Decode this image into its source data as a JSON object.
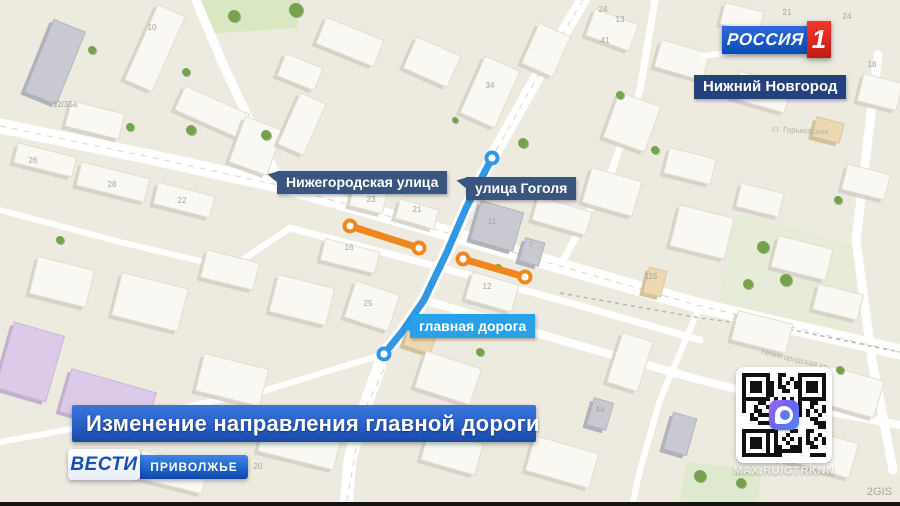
{
  "branding": {
    "channel": "РОССИЯ",
    "channel_number": "1",
    "region_label": "Нижний Новгород",
    "vesti": "ВЕСТИ",
    "vesti_region": "ПРИВОЛЖЬЕ"
  },
  "headline": "Изменение направления главной дороги",
  "map_labels": {
    "street1": "Нижегородская улица",
    "street2": "улица Гоголя",
    "main_road": "главная дорога"
  },
  "qr": {
    "caption": "MAX.RU/GTRKNN",
    "icon": "max-messenger-icon"
  },
  "watermark": "2GIS",
  "colors": {
    "map_bg": "#edeae0",
    "road": "#ffffff",
    "street_tag": "#3a557e",
    "city_tag": "#24417c",
    "mainroad_tag": "#2aa0e8",
    "route_blue": "#2f97e3",
    "route_orange": "#f0861e",
    "banner_top": "#3a77dd",
    "banner_bottom": "#1b4aa8",
    "rossiya_blue": "#0c4ab8",
    "rossiya_red": "#d8231a"
  },
  "map": {
    "park": [
      {
        "pts": [
          [
            200,
            0
          ],
          [
            300,
            0
          ],
          [
            297,
            28
          ],
          [
            204,
            34
          ]
        ],
        "c": "#d9e8c2"
      },
      {
        "pts": [
          [
            735,
            213
          ],
          [
            862,
            248
          ],
          [
            846,
            342
          ],
          [
            718,
            302
          ]
        ],
        "c": "#e7ecd9"
      },
      {
        "pts": [
          [
            686,
            462
          ],
          [
            762,
            470
          ],
          [
            758,
            506
          ],
          [
            680,
            506
          ]
        ],
        "c": "#dfe9cd"
      }
    ],
    "roads": [
      {
        "pts": [
          [
            0,
            210
          ],
          [
            120,
            242
          ],
          [
            230,
            268
          ],
          [
            290,
            228
          ]
        ],
        "w": 6
      },
      {
        "pts": [
          [
            384,
            354
          ],
          [
            260,
            392
          ],
          [
            120,
            420
          ],
          [
            0,
            442
          ]
        ],
        "w": 6
      },
      {
        "pts": [
          [
            560,
            266
          ],
          [
            612,
            170
          ],
          [
            640,
            90
          ],
          [
            655,
            0
          ]
        ],
        "w": 7
      },
      {
        "pts": [
          [
            290,
            228
          ],
          [
            420,
            262
          ],
          [
            560,
            300
          ],
          [
            700,
            340
          ]
        ],
        "w": 7
      },
      {
        "pts": [
          [
            424,
            300
          ],
          [
            560,
            340
          ],
          [
            700,
            380
          ],
          [
            830,
            412
          ],
          [
            900,
            425
          ]
        ],
        "w": 8
      },
      {
        "pts": [
          [
            700,
            306
          ],
          [
            660,
            400
          ],
          [
            640,
            470
          ],
          [
            632,
            506
          ]
        ],
        "w": 6
      },
      {
        "pts": [
          [
            878,
            55
          ],
          [
            856,
            240
          ],
          [
            872,
            360
          ],
          [
            893,
            470
          ]
        ],
        "w": 9
      },
      {
        "pts": [
          [
            196,
            0
          ],
          [
            222,
            62
          ],
          [
            250,
            122
          ],
          [
            282,
            186
          ]
        ],
        "w": 9
      },
      {
        "pts": [
          [
            583,
            0
          ],
          [
            540,
            72
          ],
          [
            492,
            158
          ],
          [
            466,
            208
          ],
          [
            447,
            252
          ],
          [
            424,
            300
          ],
          [
            402,
            332
          ],
          [
            384,
            354
          ],
          [
            362,
            415
          ],
          [
            350,
            460
          ],
          [
            346,
            506
          ]
        ],
        "w": 13
      },
      {
        "pts": [
          [
            0,
            126
          ],
          [
            150,
            157
          ],
          [
            282,
            186
          ],
          [
            430,
            228
          ],
          [
            560,
            266
          ],
          [
            700,
            306
          ],
          [
            900,
            352
          ]
        ],
        "w": 15
      }
    ],
    "centerlines": [
      {
        "pts": [
          [
            0,
            126
          ],
          [
            150,
            157
          ],
          [
            282,
            186
          ],
          [
            430,
            228
          ],
          [
            560,
            266
          ],
          [
            700,
            306
          ],
          [
            900,
            352
          ]
        ]
      },
      {
        "pts": [
          [
            583,
            0
          ],
          [
            540,
            72
          ],
          [
            492,
            158
          ],
          [
            447,
            252
          ],
          [
            402,
            332
          ],
          [
            362,
            415
          ],
          [
            346,
            506
          ]
        ]
      }
    ],
    "boundary": {
      "pts": [
        [
          560,
          293
        ],
        [
          700,
          318
        ],
        [
          793,
          330
        ],
        [
          900,
          352
        ]
      ]
    },
    "buildings": [
      {
        "x": 55,
        "y": 62,
        "w": 34,
        "h": 78,
        "r": 22,
        "c": "g"
      },
      {
        "x": 155,
        "y": 48,
        "w": 30,
        "h": 82,
        "r": 24,
        "c": "w"
      },
      {
        "x": 95,
        "y": 120,
        "w": 55,
        "h": 26,
        "r": 14,
        "c": "w"
      },
      {
        "x": 212,
        "y": 112,
        "w": 70,
        "h": 26,
        "r": 24,
        "c": "w"
      },
      {
        "x": 45,
        "y": 160,
        "w": 60,
        "h": 20,
        "r": 14,
        "c": "w"
      },
      {
        "x": 113,
        "y": 182,
        "w": 70,
        "h": 24,
        "r": 14,
        "c": "w"
      },
      {
        "x": 184,
        "y": 200,
        "w": 58,
        "h": 22,
        "r": 14,
        "c": "w"
      },
      {
        "x": 256,
        "y": 146,
        "w": 40,
        "h": 48,
        "r": 20,
        "c": "w"
      },
      {
        "x": 302,
        "y": 124,
        "w": 28,
        "h": 56,
        "r": 24,
        "c": "w"
      },
      {
        "x": 350,
        "y": 42,
        "w": 62,
        "h": 28,
        "r": 22,
        "c": "w"
      },
      {
        "x": 300,
        "y": 72,
        "w": 40,
        "h": 24,
        "r": 22,
        "c": "w"
      },
      {
        "x": 432,
        "y": 62,
        "w": 48,
        "h": 34,
        "r": 24,
        "c": "w"
      },
      {
        "x": 490,
        "y": 92,
        "w": 38,
        "h": 62,
        "r": 24,
        "c": "w"
      },
      {
        "x": 546,
        "y": 50,
        "w": 34,
        "h": 44,
        "r": 24,
        "c": "w"
      },
      {
        "x": 612,
        "y": 30,
        "w": 46,
        "h": 28,
        "r": 20,
        "c": "w"
      },
      {
        "x": 682,
        "y": 60,
        "w": 50,
        "h": 28,
        "r": 16,
        "c": "w"
      },
      {
        "x": 762,
        "y": 92,
        "w": 54,
        "h": 28,
        "r": 16,
        "c": "w"
      },
      {
        "x": 828,
        "y": 130,
        "w": 28,
        "h": 20,
        "r": 14,
        "c": "t"
      },
      {
        "x": 866,
        "y": 182,
        "w": 44,
        "h": 26,
        "r": 14,
        "c": "w"
      },
      {
        "x": 880,
        "y": 92,
        "w": 40,
        "h": 28,
        "r": 14,
        "c": "w"
      },
      {
        "x": 632,
        "y": 122,
        "w": 44,
        "h": 48,
        "r": 20,
        "c": "w"
      },
      {
        "x": 690,
        "y": 166,
        "w": 48,
        "h": 26,
        "r": 14,
        "c": "w"
      },
      {
        "x": 760,
        "y": 200,
        "w": 44,
        "h": 24,
        "r": 14,
        "c": "w"
      },
      {
        "x": 368,
        "y": 200,
        "w": 34,
        "h": 20,
        "r": 14,
        "c": "w"
      },
      {
        "x": 417,
        "y": 214,
        "w": 40,
        "h": 20,
        "r": 16,
        "c": "w"
      },
      {
        "x": 350,
        "y": 256,
        "w": 56,
        "h": 22,
        "r": 14,
        "c": "w"
      },
      {
        "x": 372,
        "y": 306,
        "w": 46,
        "h": 38,
        "r": 18,
        "c": "w"
      },
      {
        "x": 420,
        "y": 340,
        "w": 28,
        "h": 20,
        "r": 18,
        "c": "t"
      },
      {
        "x": 448,
        "y": 378,
        "w": 58,
        "h": 38,
        "r": 18,
        "c": "w"
      },
      {
        "x": 302,
        "y": 300,
        "w": 58,
        "h": 38,
        "r": 14,
        "c": "w"
      },
      {
        "x": 230,
        "y": 270,
        "w": 54,
        "h": 28,
        "r": 14,
        "c": "w"
      },
      {
        "x": 150,
        "y": 302,
        "w": 68,
        "h": 44,
        "r": 14,
        "c": "w"
      },
      {
        "x": 62,
        "y": 282,
        "w": 58,
        "h": 38,
        "r": 14,
        "c": "w"
      },
      {
        "x": 30,
        "y": 362,
        "w": 52,
        "h": 68,
        "r": 16,
        "c": "p"
      },
      {
        "x": 108,
        "y": 402,
        "w": 88,
        "h": 44,
        "r": 16,
        "c": "p"
      },
      {
        "x": 232,
        "y": 380,
        "w": 66,
        "h": 38,
        "r": 14,
        "c": "w"
      },
      {
        "x": 300,
        "y": 442,
        "w": 78,
        "h": 38,
        "r": 14,
        "c": "w"
      },
      {
        "x": 172,
        "y": 472,
        "w": 68,
        "h": 28,
        "r": 14,
        "c": "w"
      },
      {
        "x": 497,
        "y": 226,
        "w": 44,
        "h": 40,
        "r": 16,
        "c": "g"
      },
      {
        "x": 532,
        "y": 252,
        "w": 20,
        "h": 24,
        "r": 16,
        "c": "g"
      },
      {
        "x": 492,
        "y": 292,
        "w": 48,
        "h": 28,
        "r": 16,
        "c": "w"
      },
      {
        "x": 562,
        "y": 216,
        "w": 56,
        "h": 24,
        "r": 16,
        "c": "w"
      },
      {
        "x": 612,
        "y": 192,
        "w": 52,
        "h": 36,
        "r": 16,
        "c": "w"
      },
      {
        "x": 655,
        "y": 282,
        "w": 18,
        "h": 26,
        "r": 14,
        "c": "t"
      },
      {
        "x": 702,
        "y": 232,
        "w": 56,
        "h": 42,
        "r": 14,
        "c": "w"
      },
      {
        "x": 802,
        "y": 258,
        "w": 56,
        "h": 32,
        "r": 14,
        "c": "w"
      },
      {
        "x": 838,
        "y": 302,
        "w": 46,
        "h": 26,
        "r": 14,
        "c": "w"
      },
      {
        "x": 630,
        "y": 362,
        "w": 32,
        "h": 52,
        "r": 18,
        "c": "w"
      },
      {
        "x": 600,
        "y": 414,
        "w": 20,
        "h": 28,
        "r": 16,
        "c": "g"
      },
      {
        "x": 680,
        "y": 434,
        "w": 24,
        "h": 38,
        "r": 16,
        "c": "g"
      },
      {
        "x": 762,
        "y": 332,
        "w": 56,
        "h": 30,
        "r": 14,
        "c": "w"
      },
      {
        "x": 852,
        "y": 392,
        "w": 56,
        "h": 38,
        "r": 16,
        "c": "w"
      },
      {
        "x": 822,
        "y": 452,
        "w": 66,
        "h": 36,
        "r": 16,
        "c": "w"
      },
      {
        "x": 562,
        "y": 462,
        "w": 66,
        "h": 36,
        "r": 16,
        "c": "w"
      },
      {
        "x": 452,
        "y": 452,
        "w": 56,
        "h": 32,
        "r": 16,
        "c": "w"
      },
      {
        "x": 742,
        "y": 18,
        "w": 40,
        "h": 22,
        "r": 14,
        "c": "w"
      }
    ],
    "trees": [
      [
        234,
        16,
        6
      ],
      [
        296,
        10,
        7
      ],
      [
        266,
        135,
        5
      ],
      [
        191,
        130,
        5
      ],
      [
        130,
        127,
        4
      ],
      [
        92,
        50,
        4
      ],
      [
        186,
        72,
        4
      ],
      [
        320,
        178,
        4
      ],
      [
        523,
        143,
        5
      ],
      [
        498,
        268,
        4
      ],
      [
        480,
        352,
        4
      ],
      [
        620,
        95,
        4
      ],
      [
        655,
        150,
        4
      ],
      [
        763,
        247,
        6
      ],
      [
        786,
        280,
        6
      ],
      [
        748,
        284,
        5
      ],
      [
        838,
        200,
        4
      ],
      [
        60,
        240,
        4
      ],
      [
        700,
        476,
        6
      ],
      [
        741,
        483,
        5
      ],
      [
        840,
        370,
        4
      ],
      [
        455,
        120,
        3
      ]
    ],
    "numbers": [
      {
        "t": "10",
        "x": 152,
        "y": 30
      },
      {
        "t": "34",
        "x": 490,
        "y": 88
      },
      {
        "t": "24",
        "x": 603,
        "y": 12
      },
      {
        "t": "41",
        "x": 605,
        "y": 43
      },
      {
        "t": "21",
        "x": 787,
        "y": 15
      },
      {
        "t": "24",
        "x": 847,
        "y": 19
      },
      {
        "t": "18",
        "x": 872,
        "y": 67
      },
      {
        "t": "26",
        "x": 33,
        "y": 163
      },
      {
        "t": "28",
        "x": 112,
        "y": 187
      },
      {
        "t": "22",
        "x": 182,
        "y": 203
      },
      {
        "t": "12/35а",
        "x": 65,
        "y": 107
      },
      {
        "t": "23",
        "x": 371,
        "y": 202
      },
      {
        "t": "21",
        "x": 417,
        "y": 212
      },
      {
        "t": "16",
        "x": 349,
        "y": 250
      },
      {
        "t": "11",
        "x": 492,
        "y": 224
      },
      {
        "t": "7",
        "x": 531,
        "y": 247
      },
      {
        "t": "12",
        "x": 487,
        "y": 289
      },
      {
        "t": "25",
        "x": 368,
        "y": 306
      },
      {
        "t": "27а",
        "x": 418,
        "y": 337
      },
      {
        "t": "115",
        "x": 651,
        "y": 279
      },
      {
        "t": "4а",
        "x": 600,
        "y": 412
      },
      {
        "t": "20",
        "x": 258,
        "y": 469
      },
      {
        "t": "13",
        "x": 620,
        "y": 22
      }
    ],
    "street_names": [
      {
        "t": "Нижегородская ул.",
        "x": 795,
        "y": 362,
        "r": 13
      },
      {
        "t": "ст. Горьковская",
        "x": 800,
        "y": 133,
        "r": 3
      }
    ],
    "routes": {
      "blue": {
        "pts": [
          [
            492,
            158
          ],
          [
            466,
            208
          ],
          [
            447,
            252
          ],
          [
            424,
            300
          ],
          [
            402,
            332
          ],
          [
            384,
            354
          ]
        ],
        "color": "#2f97e3",
        "w": 7
      },
      "orange": [
        {
          "pts": [
            [
              350,
              226
            ],
            [
              419,
              248
            ]
          ],
          "color": "#f0861e",
          "w": 7
        },
        {
          "pts": [
            [
              463,
              259
            ],
            [
              525,
              277
            ]
          ],
          "color": "#f0861e",
          "w": 7
        }
      ]
    }
  }
}
